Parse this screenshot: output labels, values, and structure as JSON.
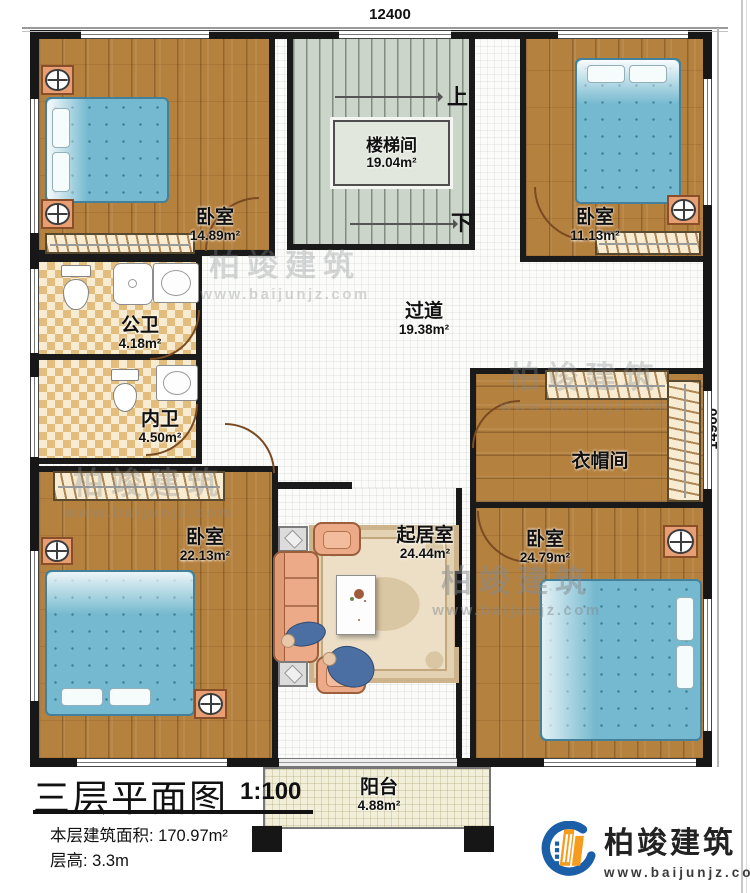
{
  "dimensions": {
    "top": "12400",
    "right": "14900"
  },
  "stairs": {
    "up": "上",
    "down": "下"
  },
  "rooms": {
    "stair_hall": {
      "name": "楼梯间",
      "area": "19.04m²"
    },
    "bedroom_tl": {
      "name": "卧室",
      "area": "14.89m²"
    },
    "bedroom_tr": {
      "name": "卧室",
      "area": "11.13m²"
    },
    "bath_public": {
      "name": "公卫",
      "area": "4.18m²"
    },
    "bath_private": {
      "name": "内卫",
      "area": "4.50m²"
    },
    "hallway": {
      "name": "过道",
      "area": "19.38m²"
    },
    "cloakroom": {
      "name": "衣帽间"
    },
    "bedroom_bl": {
      "name": "卧室",
      "area": "22.13m²"
    },
    "living_room": {
      "name": "起居室",
      "area": "24.44m²"
    },
    "bedroom_br": {
      "name": "卧室",
      "area": "24.79m²"
    },
    "balcony": {
      "name": "阳台",
      "area": "4.88m²"
    }
  },
  "title_block": {
    "title": "三层平面图",
    "scale": "1:100",
    "floor_area": "本层建筑面积: 170.97m²",
    "floor_height": "层高: 3.3m"
  },
  "brand": {
    "name": "柏竣建筑",
    "url": "www.baijunjz.com"
  },
  "watermark": {
    "name": "柏竣建筑",
    "url": "www.baijunjz.com"
  },
  "colors": {
    "wall": "#1a1a1a",
    "wood": "#b5813e",
    "tile": "#e3bd7e",
    "bed": "#74b9cf",
    "stairs": "#ccd5ca",
    "sofa": "#edaa88",
    "logo_blue": "#1b5fa8",
    "logo_orange": "#f59b1e"
  }
}
